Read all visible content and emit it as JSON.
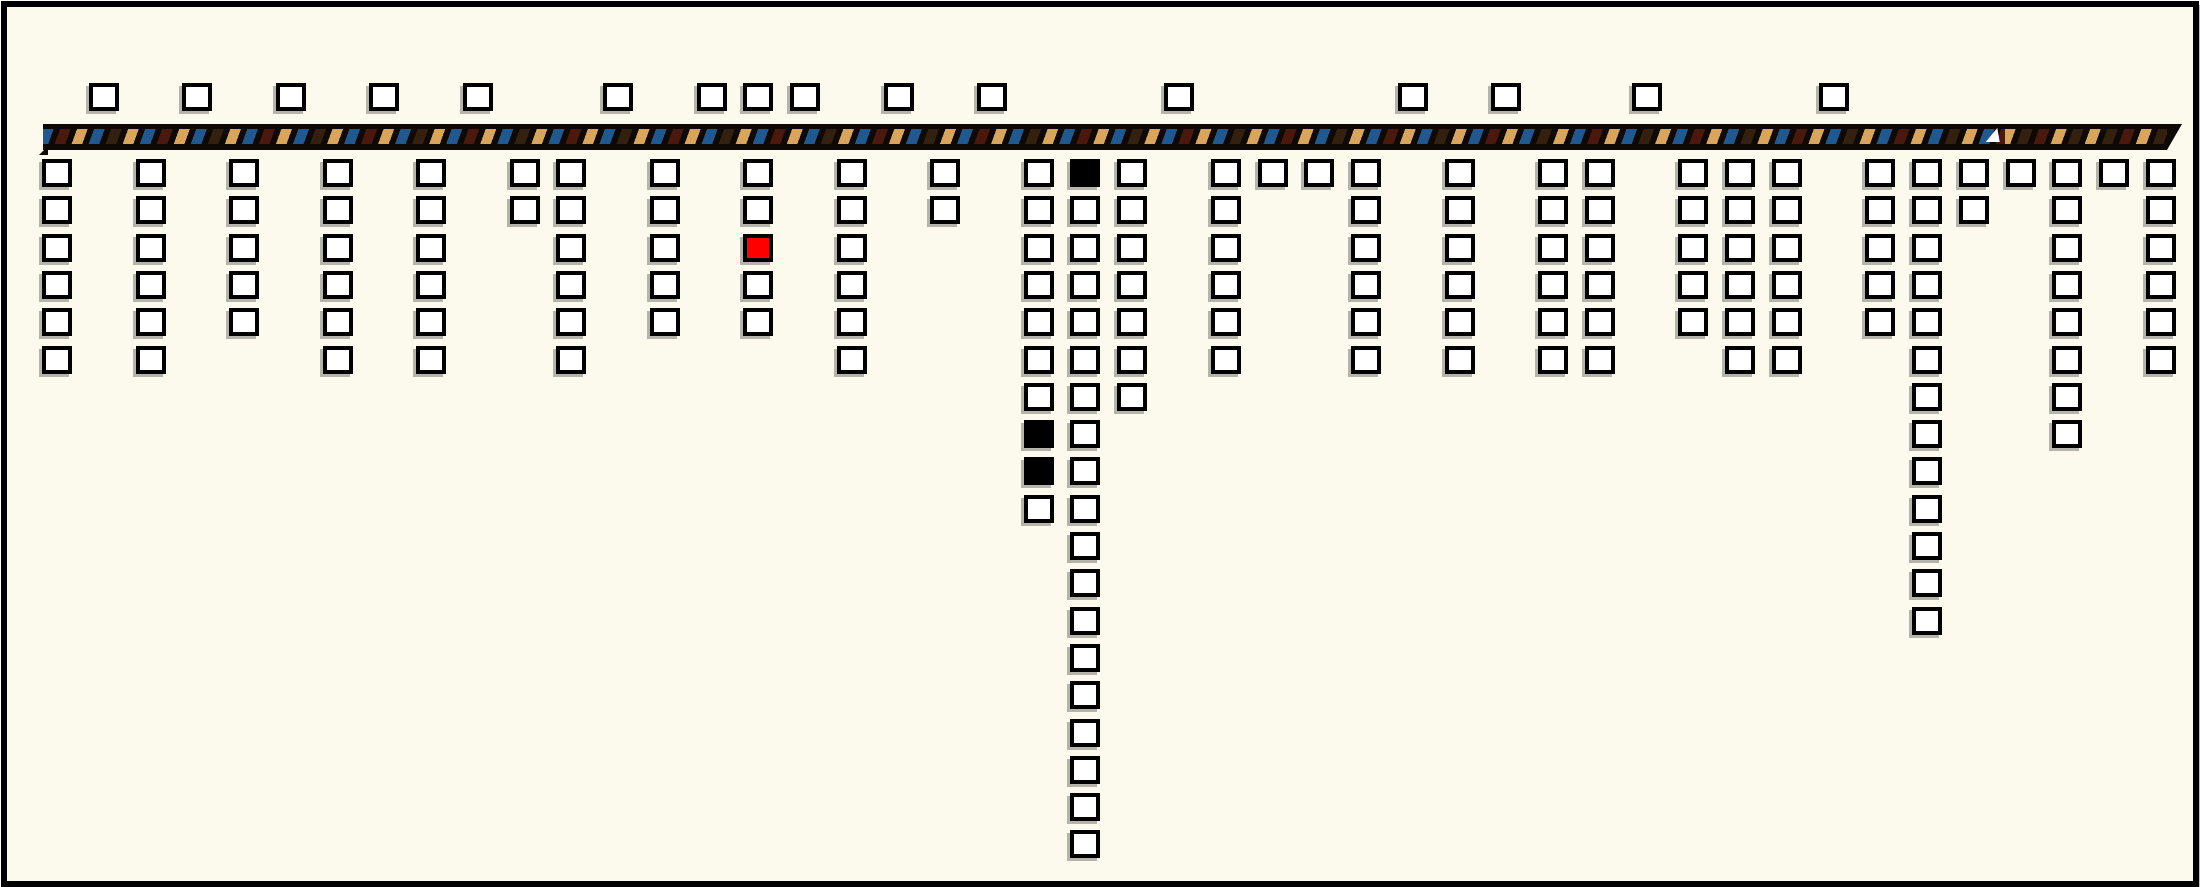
{
  "canvas": {
    "width": 2200,
    "height": 887,
    "background_color": "#fbfaec",
    "frame_border_color": "#000000"
  },
  "main_cord": {
    "x_start": 36,
    "x_end": 2160,
    "y_top": 117,
    "height": 26,
    "core_color": "#0e0905",
    "stripe_colors": {
      "blue": "#20598f",
      "maroon": "#4a180d",
      "tan": "#d9a45c",
      "brown": "#33200f"
    },
    "notch_marker_x": 1988,
    "right_section_start_x": 1998,
    "tip_style": "tapered-point"
  },
  "grid": {
    "square_width": 30,
    "square_height": 28,
    "square_border_px": 4,
    "top_row_y": 76,
    "row_start_y": 152,
    "row_pitch": 37.3,
    "fill_default": "#ffffff",
    "fill_red": "#ff0000",
    "fill_black": "#000000"
  },
  "top_squares": {
    "count": 16,
    "x_centers": [
      97,
      190,
      284,
      377,
      471,
      611,
      705,
      751,
      798,
      892,
      985,
      1172,
      1406,
      1499,
      1640,
      1827
    ]
  },
  "pendant_columns": [
    {
      "x_center": 50,
      "count": 6
    },
    {
      "x_center": 144,
      "count": 6
    },
    {
      "x_center": 237,
      "count": 5
    },
    {
      "x_center": 331,
      "count": 6
    },
    {
      "x_center": 424,
      "count": 6
    },
    {
      "x_center": 518,
      "count": 2
    },
    {
      "x_center": 564,
      "count": 6
    },
    {
      "x_center": 658,
      "count": 5
    },
    {
      "x_center": 751,
      "count": 5,
      "specials": {
        "3": "red"
      }
    },
    {
      "x_center": 845,
      "count": 6
    },
    {
      "x_center": 938,
      "count": 2
    },
    {
      "x_center": 1032,
      "count": 10,
      "specials": {
        "8": "black",
        "9": "black"
      }
    },
    {
      "x_center": 1078,
      "count": 19,
      "specials": {
        "1": "black"
      }
    },
    {
      "x_center": 1125,
      "count": 7
    },
    {
      "x_center": 1219,
      "count": 6
    },
    {
      "x_center": 1266,
      "count": 1
    },
    {
      "x_center": 1312,
      "count": 1
    },
    {
      "x_center": 1359,
      "count": 6
    },
    {
      "x_center": 1453,
      "count": 6
    },
    {
      "x_center": 1546,
      "count": 6
    },
    {
      "x_center": 1593,
      "count": 6
    },
    {
      "x_center": 1686,
      "count": 5
    },
    {
      "x_center": 1733,
      "count": 6
    },
    {
      "x_center": 1780,
      "count": 6
    },
    {
      "x_center": 1873,
      "count": 5
    },
    {
      "x_center": 1920,
      "count": 13
    },
    {
      "x_center": 1967,
      "count": 2
    },
    {
      "x_center": 2014,
      "count": 1
    },
    {
      "x_center": 2060,
      "count": 8
    },
    {
      "x_center": 2107,
      "count": 1
    },
    {
      "x_center": 2154,
      "count": 6
    }
  ]
}
